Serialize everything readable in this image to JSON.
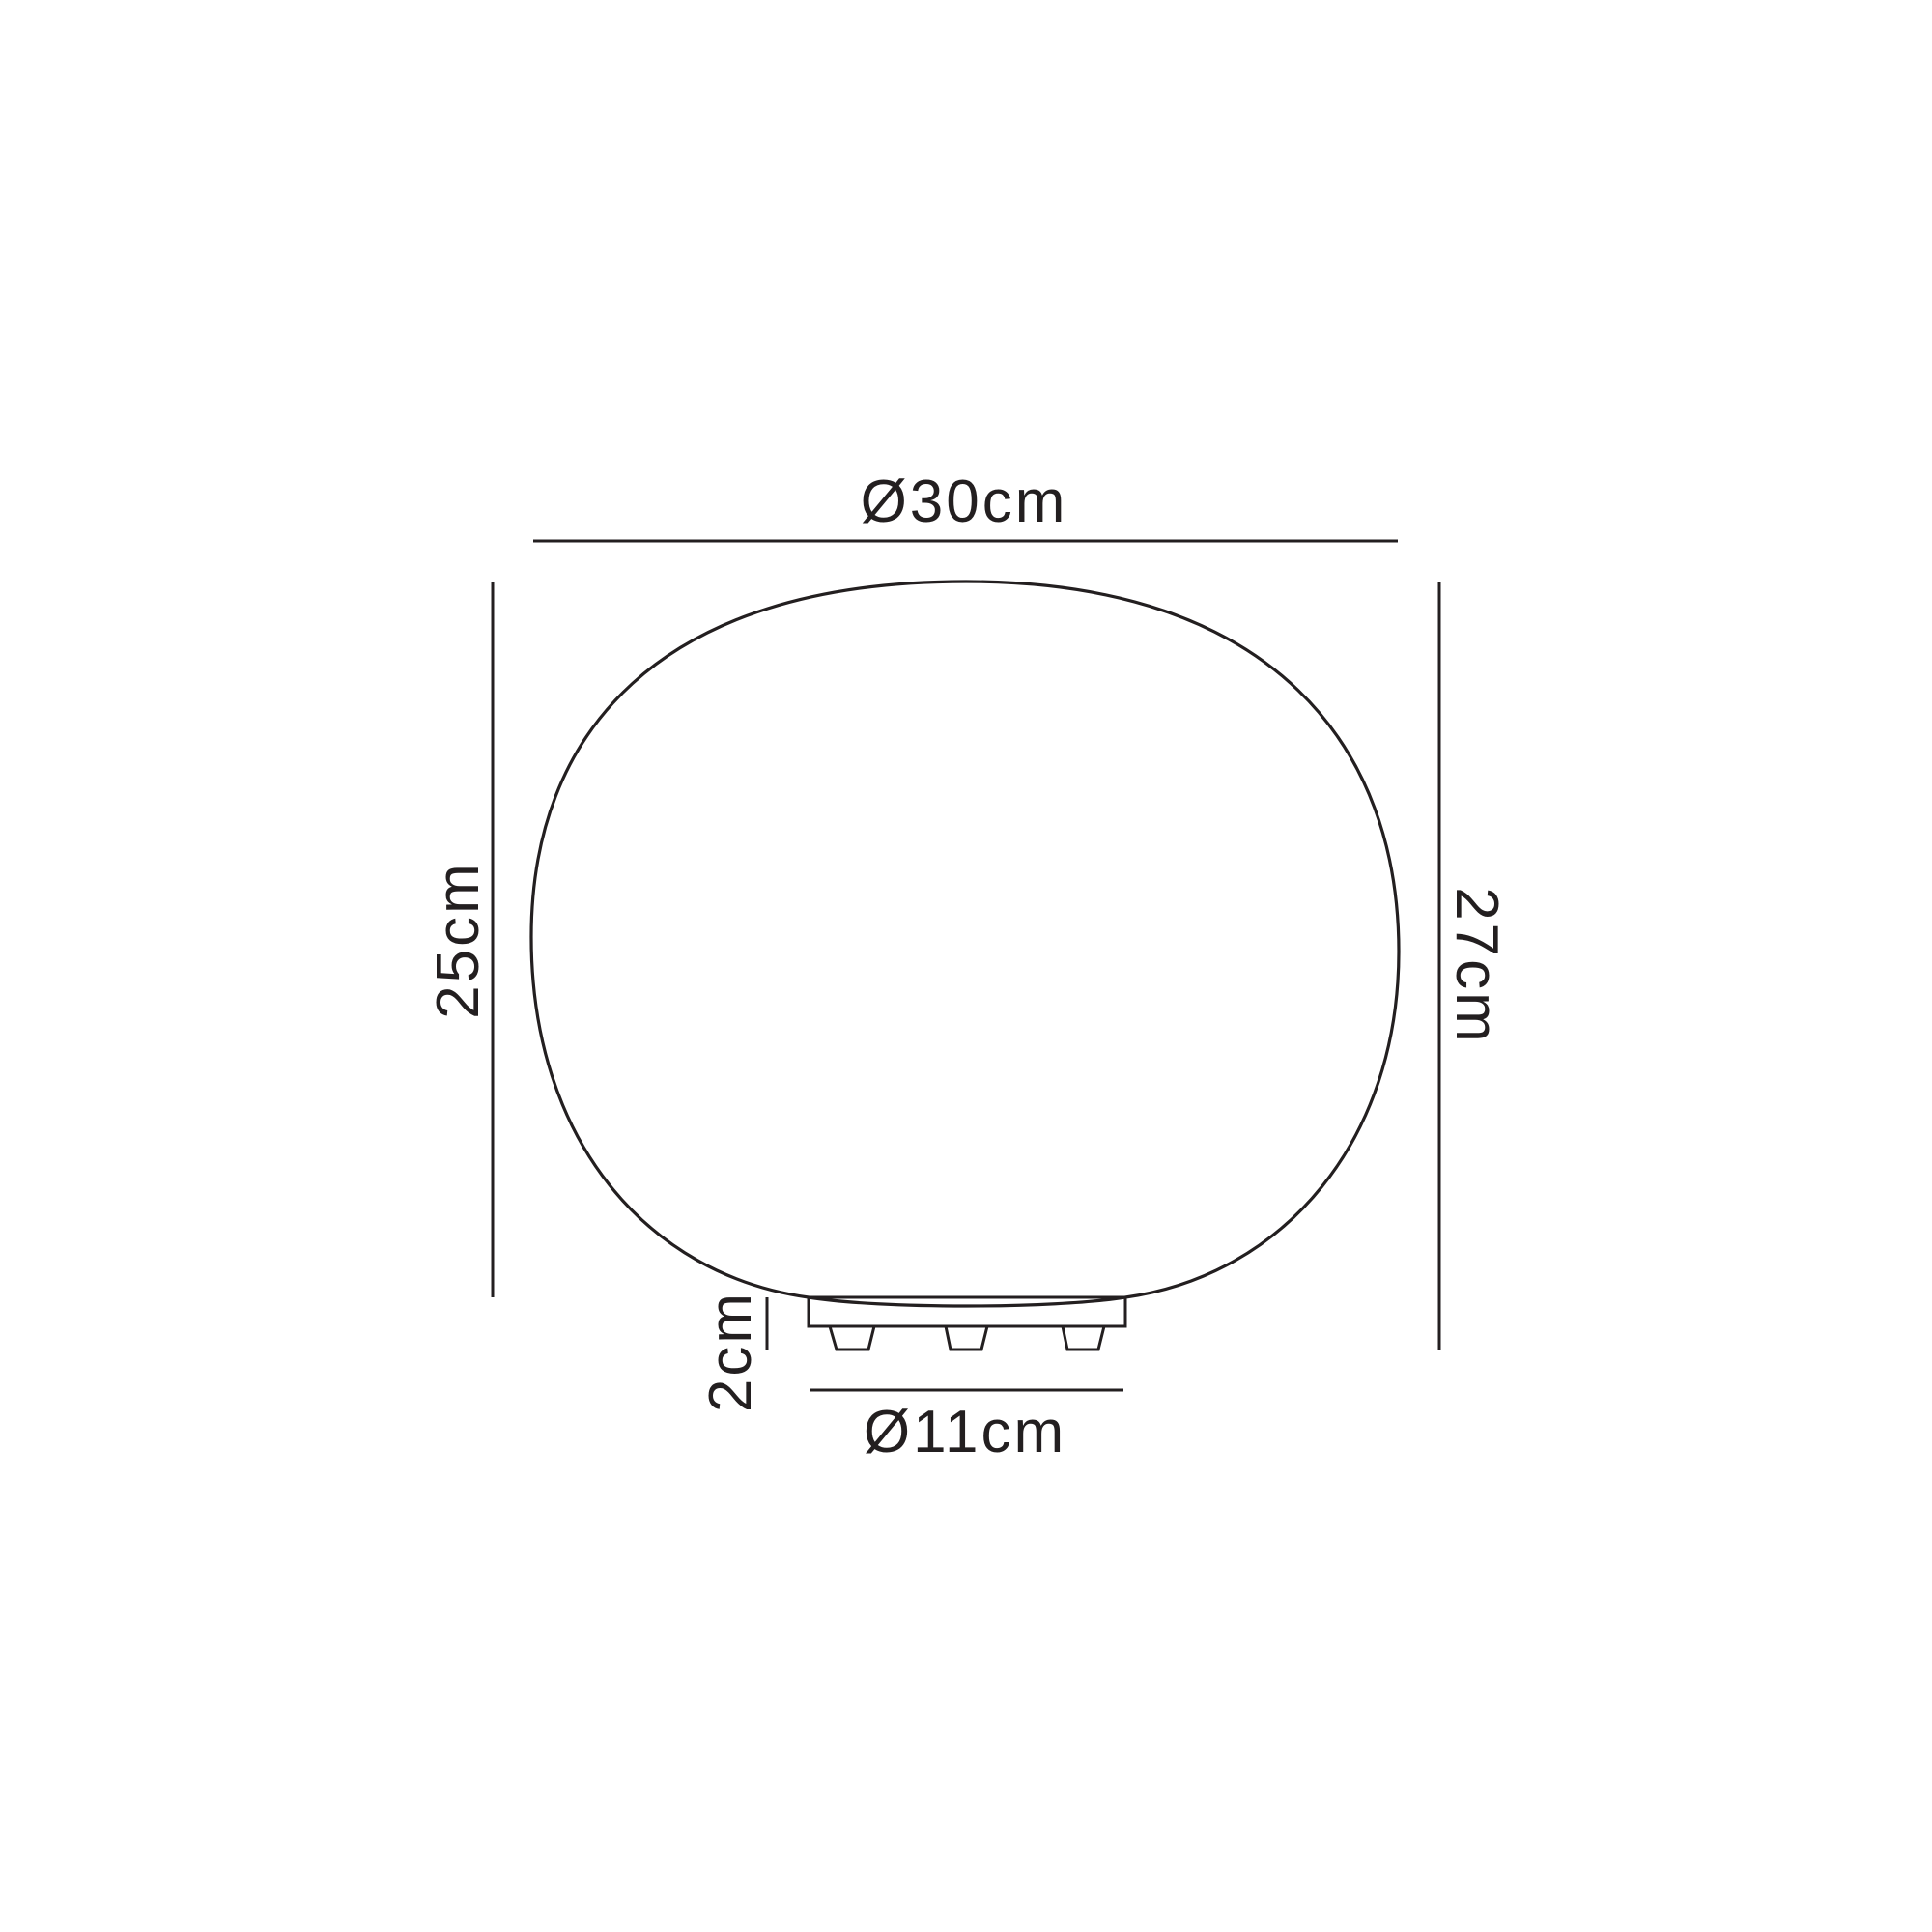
{
  "drawing": {
    "description": "technical dimension diagram of a rounded squircle glass table lamp with a low footed base",
    "background_color": "#ffffff",
    "line_color": "#231f20",
    "dimensions": {
      "shade_diameter_label": "Ø30cm",
      "shade_height_label": "25cm",
      "overall_height_label": "27cm",
      "base_height_label": "2cm",
      "base_diameter_label": "Ø11cm"
    }
  }
}
